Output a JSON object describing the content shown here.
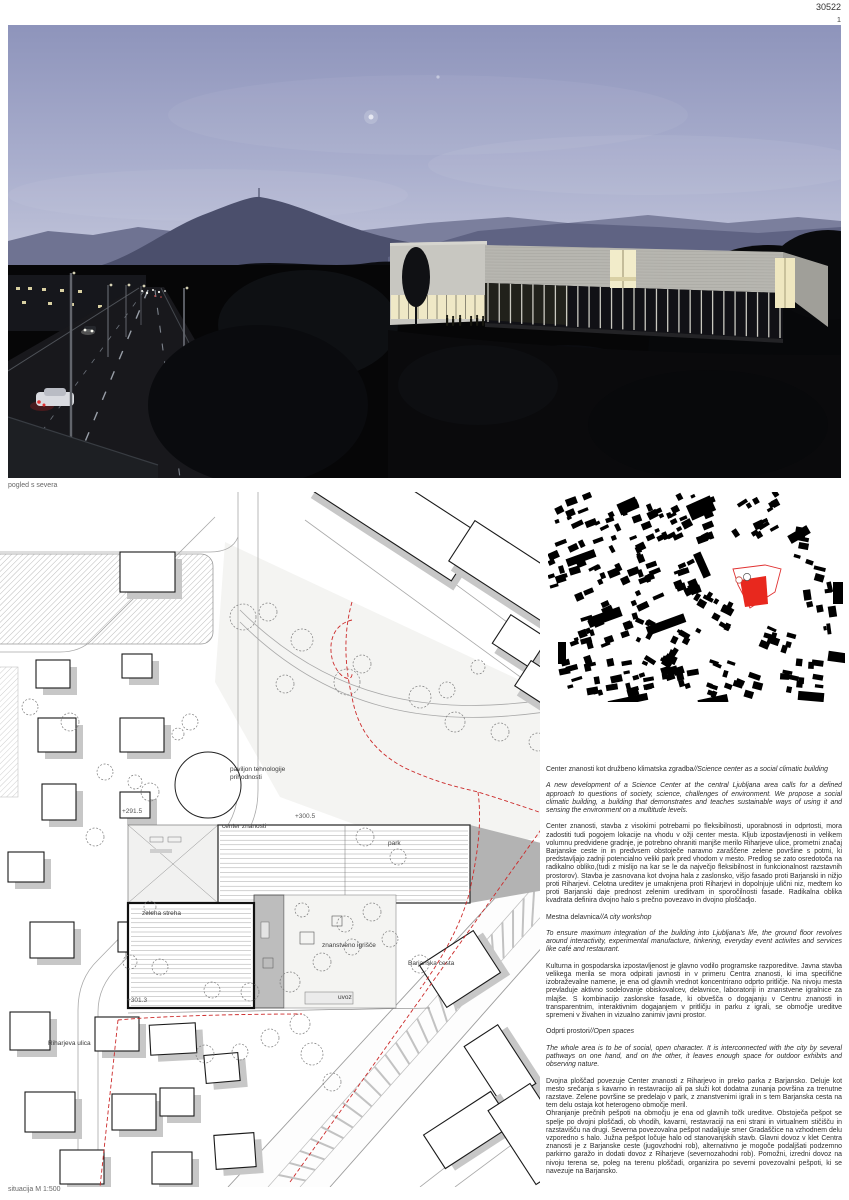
{
  "board": {
    "code": "30522",
    "page_number": "1"
  },
  "render_caption": "pogled s severa",
  "siteplan": {
    "caption": "situacija M 1:500",
    "labels": {
      "pavilion": "paviljon tehnologije prihodnosti",
      "elev_291": "+291.5",
      "elev_300": "+300.5",
      "center": "center znanosti",
      "park": "park",
      "green_roof": "zelena streha",
      "science_playground": "znanstveno igrišče",
      "barjanska": "Barjanska cesta",
      "uvoz": "uvoz",
      "elev_301": "+301.3",
      "riharjeva": "Riharjeva ulica"
    }
  },
  "text_column": {
    "sections": [
      {
        "heading_sl": "Center znanosti kot družbeno klimatska zgradba",
        "heading_en": "//Science center as a social climatic building",
        "paragraphs": [
          {
            "style": "en",
            "text": "A new development of a Science Center at the central Ljubljana area calls for a defined approach to questions of society, science, challenges of environment. We propose a social climatic building, a building that demonstrates and teaches sustainable ways of using it and sensing the environment on a multitude levels."
          },
          {
            "style": "sl",
            "text": "Center znanosti, stavba z visokimi potrebami po fleksibilnosti, uporabnosti in odprtosti, mora zadostiti tudi pogojem lokacije na vhodu v ožji center mesta. Kljub izpostavljenosti in velikem volumnu predvidene gradnje, je potrebno ohraniti manjše merilo Riharjeve ulice, prometni značaj Barjanske ceste in in predvsem obstoječe naravno zaraščene zelene površine s potmi, ki predstavljajo zadnji potencialno veliki park pred vhodom v mesto. Predlog se zato osredotoča na radikalno obliko,(tudi z mislijo na kar se le da največjo fleksibilnost in funkcionalnost razstavnih prostorov). Stavba je zasnovana kot dvojna hala z zaslonsko, višjo fasado proti Barjanski in nižjo proti Riharjevi. Celotna ureditev je umaknjena proti Riharjevi in dopolnjuje ulični niz, medtem ko proti Barjanski daje prednost zelenim ureditvam in sporočilnosti fasade. Radikalna oblika kvadrata definira dvojno halo s prečno povezavo in dvojno ploščadjo."
          }
        ]
      },
      {
        "heading_sl": "Mestna delavnica",
        "heading_en": "//A city workshop",
        "paragraphs": [
          {
            "style": "en",
            "text": "To ensure maximum integration of the building into Ljubljana's life, the ground floor revolves around interactivity, experimental manufacture, tinkering, everyday event activites and services like café and restaurant."
          },
          {
            "style": "sl",
            "text": "Kulturna in gospodarska izpostavljenost je glavno vodilo programske razporeditve. Javna stavba velikega merila se mora odpirati javnosti in v primeru Centra znanosti, ki ima specifične izobraževalne namene, je ena od glavnih vrednot koncentrirano odprto pritličje. Na nivoju mesta prevladuje aktivno sodelovanje obiskovalcev, delavnice, laboratoriji in znanstvene igralnice za mlajše. S kombinacijo zaslonske fasade, ki obvešča o dogajanju v Centru znanosti in transparentnim, interaktivnim dogajanjem v pritličju in parku z igrali, se območje ureditve spremeni v živahen in vizualno zanimiv javni prostor."
          }
        ]
      },
      {
        "heading_sl": "Odprti prostori",
        "heading_en": "//Open spaces",
        "paragraphs": [
          {
            "style": "en",
            "text": "The whole area is to be of social, open character. It is interconnected with the city by several pathways on one hand, and on the other, it leaves enough space for outdoor exhibits and observing nature."
          },
          {
            "style": "sl",
            "text": "Dvojna ploščad povezuje Center znanosti z Riharjevo in preko parka z Barjansko. Deluje kot mesto srečanja s kavarno in restavracijo ali pa služi kot dodatna zunanja površina za trenutne razstave. Zelene površine se predelajo v park, z znanstvenimi igrali in s tem Barjanska cesta na tem delu ostaja kot heterogeno območje meril."
          },
          {
            "style": "sl",
            "text": "Ohranjanje prečnih pešpoti na območju je ena od glavnih točk ureditve. Obstoječa pešpot se spelje po dvojni ploščadi, ob vhodih, kavarni, restavraciji na eni strani in virtualnem stičišču in razstavišču na drugi. Severna povezovalna pešpot nadaljuje smer Gradaščice na vzhodnem delu vzporedno s halo. Južna pešpot ločuje halo od stanovanjskih stavb. Glavni dovoz v klet Centra znanosti je z Barjanske ceste (jugovzhodni rob), alternativno je mogoče podaljšati podzemno parkirno garažo in dodati dovoz z Riharjeve (severnozahodni rob). Pomožni, izredni dovoz na nivoju terena se, poleg na terenu ploščadi, organizira po severni povezovalni pešpoti, ki se navezuje na Barjansko."
          }
        ]
      }
    ]
  }
}
